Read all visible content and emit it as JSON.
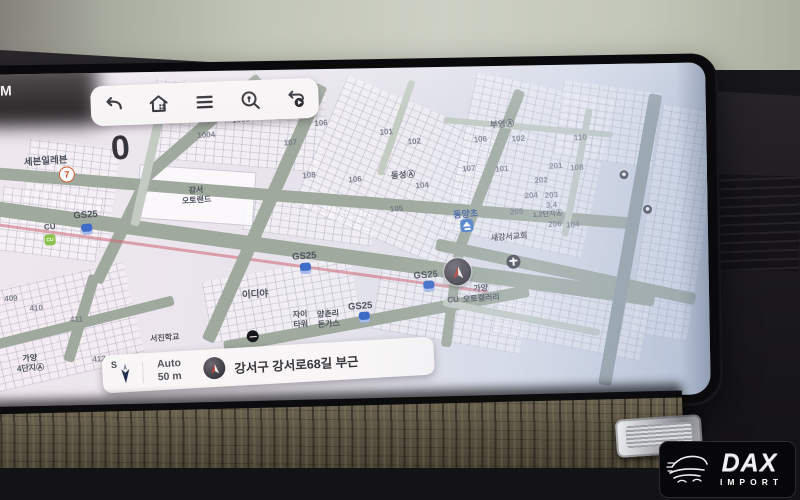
{
  "screen": {
    "status_clock": "AM",
    "toolbar_icons": [
      "back",
      "home",
      "menu",
      "search-place",
      "route-replay"
    ],
    "bottom_bar": {
      "compass": "S",
      "scale_mode": "Auto",
      "scale_value": "50 m",
      "address": "강서구 강서로68길 부근"
    }
  },
  "watermark": {
    "brand": "DAX",
    "sub": "IMPORT"
  },
  "colors": {
    "map_base": "#eae3eb",
    "road": "#9fa99d",
    "toolbar_bg": "#f7f4f5",
    "gs25_blue": "#3f6cc9",
    "cu_green": "#8bc14b",
    "marker_red": "#b8413a"
  },
  "map_items": [
    {
      "t": "세븐일레븐",
      "c": "poi",
      "x": 117,
      "y": 86
    },
    {
      "t": "7",
      "c": "ic-seven",
      "x": 138,
      "y": 101
    },
    {
      "t": "GS25",
      "c": "poi",
      "x": 156,
      "y": 142
    },
    {
      "t": "",
      "c": "ic-gs",
      "x": 157,
      "y": 156
    },
    {
      "t": "CU",
      "c": "poi-sm",
      "x": 120,
      "y": 153
    },
    {
      "t": "CU",
      "c": "ic-cu",
      "x": 120,
      "y": 166
    },
    {
      "t": "0",
      "c": "big0",
      "x": 192,
      "y": 76
    },
    {
      "t": "강서\n오토랜드",
      "c": "poi2",
      "x": 267,
      "y": 124
    },
    {
      "t": "1004",
      "c": "num",
      "x": 278,
      "y": 64
    },
    {
      "t": "1005",
      "c": "num",
      "x": 313,
      "y": 49
    },
    {
      "t": "106",
      "c": "num",
      "x": 393,
      "y": 54
    },
    {
      "t": "107",
      "c": "num",
      "x": 362,
      "y": 73
    },
    {
      "t": "108",
      "c": "num",
      "x": 380,
      "y": 106
    },
    {
      "t": "106",
      "c": "num",
      "x": 426,
      "y": 111
    },
    {
      "t": "105",
      "c": "num",
      "x": 467,
      "y": 141
    },
    {
      "t": "101",
      "c": "num",
      "x": 458,
      "y": 64
    },
    {
      "t": "102",
      "c": "num",
      "x": 486,
      "y": 74
    },
    {
      "t": "동성Ⓐ",
      "c": "apt",
      "x": 474,
      "y": 107
    },
    {
      "t": "104",
      "c": "num",
      "x": 493,
      "y": 118
    },
    {
      "t": "부영Ⓐ",
      "c": "apt",
      "x": 574,
      "y": 58
    },
    {
      "t": "106",
      "c": "num",
      "x": 552,
      "y": 73
    },
    {
      "t": "102",
      "c": "num",
      "x": 590,
      "y": 73
    },
    {
      "t": "107",
      "c": "num",
      "x": 540,
      "y": 102
    },
    {
      "t": "101",
      "c": "num",
      "x": 573,
      "y": 103
    },
    {
      "t": "110",
      "c": "num",
      "x": 652,
      "y": 73
    },
    {
      "t": "201",
      "c": "num",
      "x": 627,
      "y": 101
    },
    {
      "t": "108",
      "c": "num",
      "x": 648,
      "y": 103
    },
    {
      "t": "202",
      "c": "num",
      "x": 612,
      "y": 115
    },
    {
      "t": "204",
      "c": "num",
      "x": 602,
      "y": 130
    },
    {
      "t": "203",
      "c": "num",
      "x": 622,
      "y": 130
    },
    {
      "t": "205",
      "c": "num",
      "x": 587,
      "y": 146
    },
    {
      "t": "3,4",
      "c": "num",
      "x": 622,
      "y": 140
    },
    {
      "t": "1,2단지Ⓐ",
      "c": "apt-sm",
      "x": 618,
      "y": 149
    },
    {
      "t": "206",
      "c": "num",
      "x": 625,
      "y": 159
    },
    {
      "t": "104",
      "c": "num",
      "x": 643,
      "y": 160
    },
    {
      "t": "동양초",
      "c": "poi-blue",
      "x": 536,
      "y": 147
    },
    {
      "t": "",
      "c": "ic-school",
      "x": 537,
      "y": 159
    },
    {
      "t": "새강서교회",
      "c": "poi-sm",
      "x": 579,
      "y": 171
    },
    {
      "t": "",
      "c": "ic-church",
      "x": 583,
      "y": 183
    },
    {
      "t": "GS25",
      "c": "poi",
      "x": 374,
      "y": 187
    },
    {
      "t": "",
      "c": "ic-gs",
      "x": 375,
      "y": 199
    },
    {
      "t": "GS25",
      "c": "poi",
      "x": 495,
      "y": 208
    },
    {
      "t": "",
      "c": "ic-gs",
      "x": 498,
      "y": 219
    },
    {
      "t": "가양\n오토갤러리",
      "c": "poi2",
      "x": 550,
      "y": 227
    },
    {
      "t": "CU",
      "c": "poi-sm",
      "x": 522,
      "y": 233
    },
    {
      "t": "이디야",
      "c": "poi",
      "x": 324,
      "y": 223
    },
    {
      "t": "",
      "c": "ic-ediya",
      "x": 321,
      "y": 239
    },
    {
      "t": "GS25",
      "c": "poi",
      "x": 429,
      "y": 238
    },
    {
      "t": "",
      "c": "ic-gs",
      "x": 433,
      "y": 249
    },
    {
      "t": "자이\n타워",
      "c": "poi2",
      "x": 369,
      "y": 250
    },
    {
      "t": "양촌리\n돈가스",
      "c": "poi2",
      "x": 397,
      "y": 250
    },
    {
      "t": "409",
      "c": "num",
      "x": 80,
      "y": 224
    },
    {
      "t": "410",
      "c": "num",
      "x": 105,
      "y": 234
    },
    {
      "t": "411",
      "c": "num",
      "x": 145,
      "y": 246
    },
    {
      "t": "412",
      "c": "num",
      "x": 167,
      "y": 286
    },
    {
      "t": "가양\n4단지Ⓐ",
      "c": "poi2",
      "x": 98,
      "y": 289
    },
    {
      "t": "서진학교",
      "c": "poi-sm",
      "x": 233,
      "y": 266
    },
    {
      "t": "",
      "c": "ic-dark",
      "x": 718,
      "y": 146
    },
    {
      "t": "",
      "c": "ic-dark",
      "x": 695,
      "y": 111
    }
  ]
}
